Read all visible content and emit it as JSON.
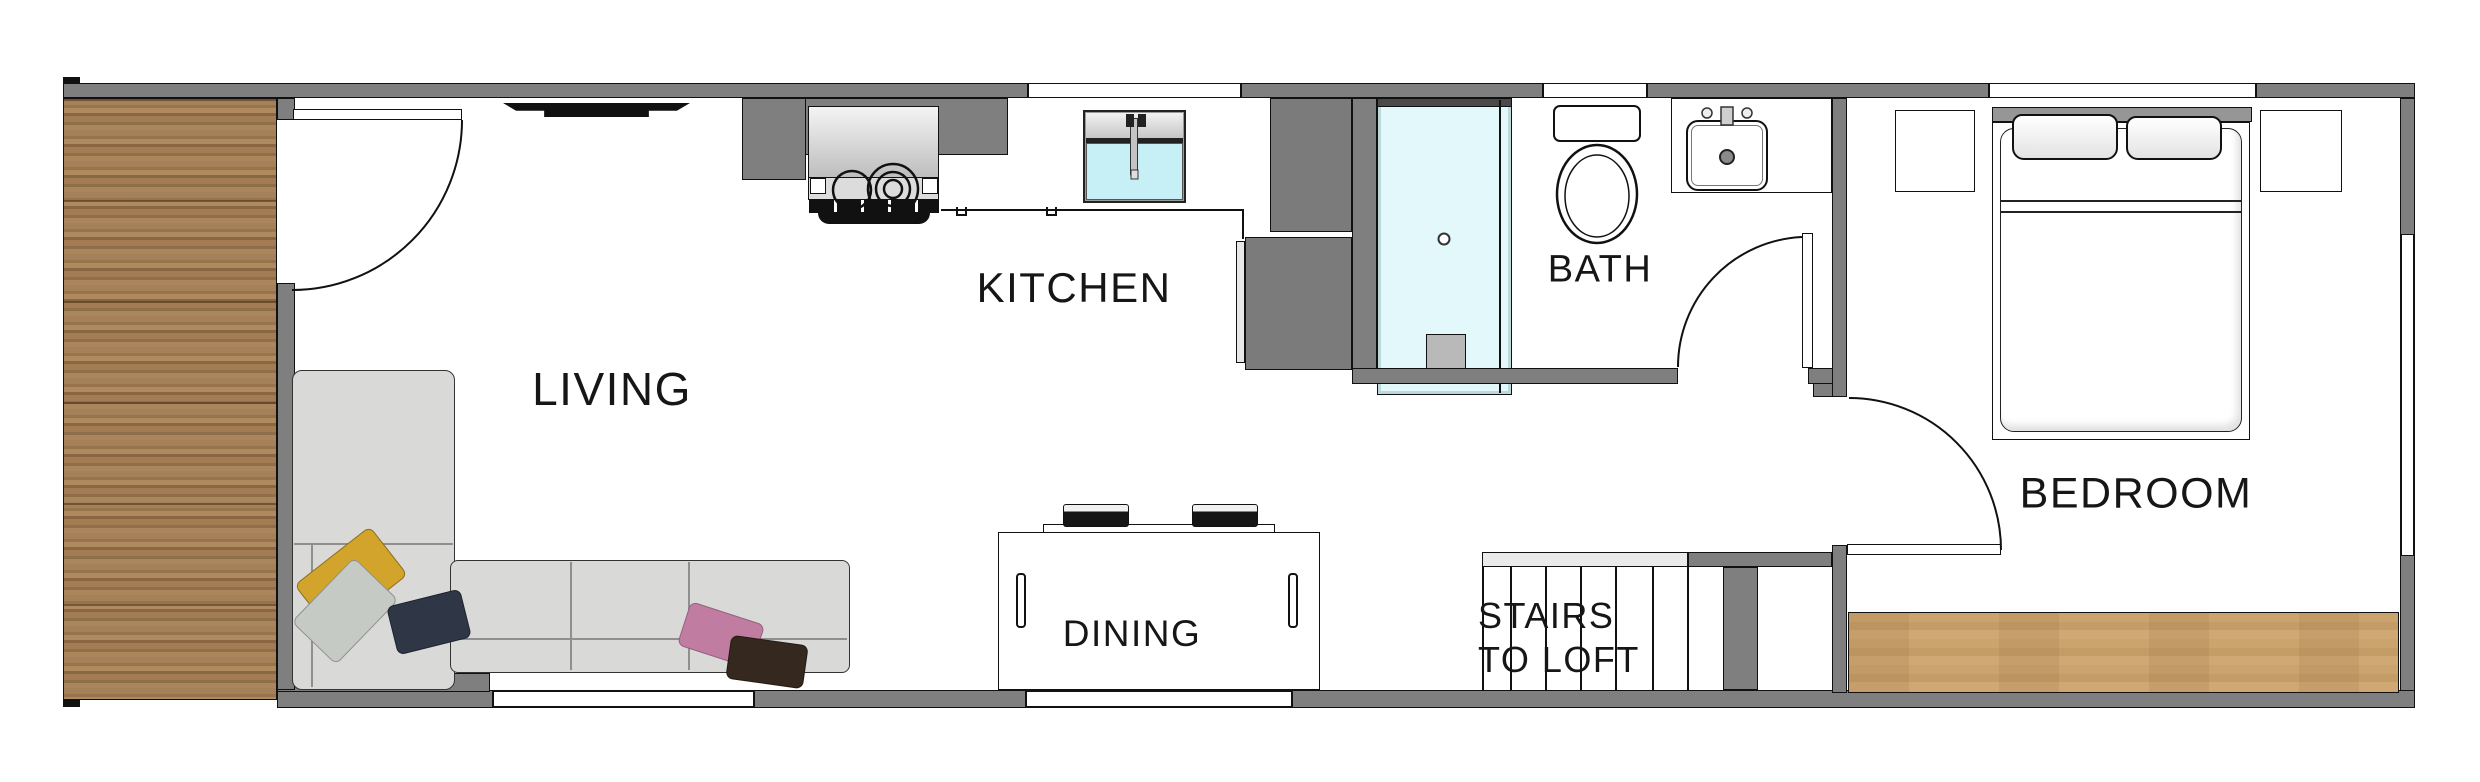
{
  "plan_title": "tiny-house-floor-plan",
  "rooms": {
    "living": {
      "label": "LIVING"
    },
    "kitchen": {
      "label": "KITCHEN"
    },
    "bath": {
      "label": "BATH"
    },
    "dining": {
      "label": "DINING"
    },
    "stairs": {
      "label_line1": "STAIRS",
      "label_line2": "TO LOFT"
    },
    "bedroom": {
      "label": "BEDROOM"
    }
  },
  "colors": {
    "wall_gray": "#7f7f7f",
    "appliance_gray": "#7b7b7b",
    "stair_landing_light": "#eaeaea",
    "shower_floor": "#e2f8fa",
    "kitchen_sink_basin": "#c6f0f6",
    "deck_wood": "#9b7950",
    "bedroom_wood": "#c8a26c",
    "sofa_gray": "#d9d9d7",
    "pillow_yellow": "#d2a42c",
    "pillow_gray": "#c6cac4",
    "pillow_navy": "#2f3746",
    "pillow_pink": "#c07da1",
    "pillow_brown": "#35291f",
    "tv_black": "#111111",
    "label_text": "#161616"
  }
}
